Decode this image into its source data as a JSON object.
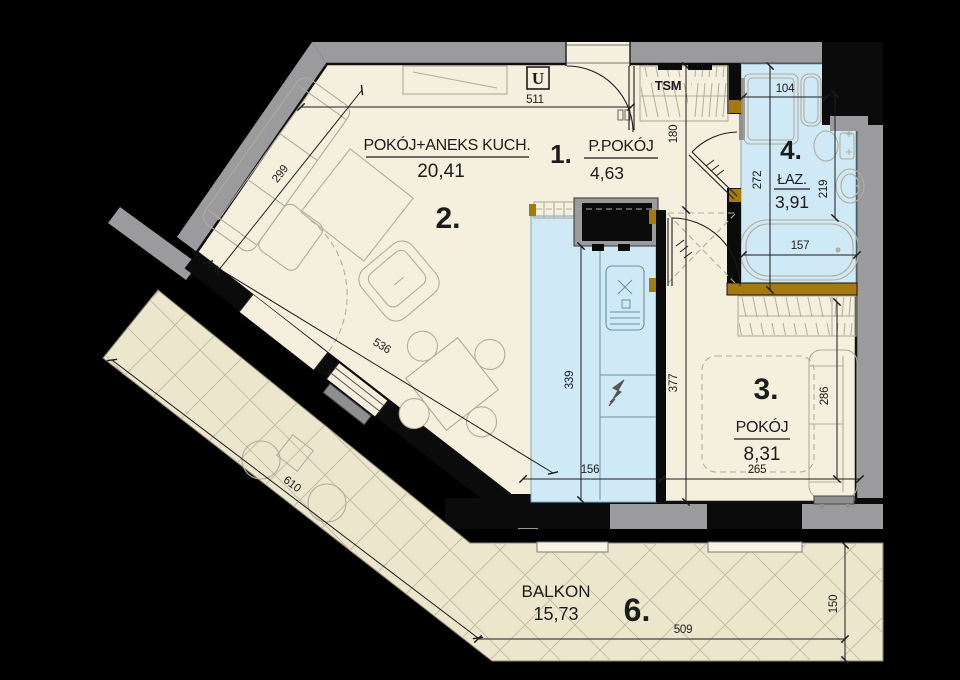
{
  "plan_title": "apartment-floor-plan",
  "rooms": {
    "r1": {
      "number": "1.",
      "name": "P.POKÓJ",
      "area": "4,63"
    },
    "r2": {
      "number": "2.",
      "name": "POKÓJ+ANEKS KUCH.",
      "area": "20,41"
    },
    "r3": {
      "number": "3.",
      "name": "POKÓJ",
      "area": "8,31"
    },
    "r4": {
      "number": "4.",
      "name": "ŁAZ.",
      "area": "3,91"
    },
    "r6": {
      "number": "6.",
      "name": "BALKON",
      "area": "15,73"
    }
  },
  "annotations": {
    "shaft_label": "TSM",
    "entrance_symbol": "U"
  },
  "dimensions_cm": {
    "d511": "511",
    "d299": "299",
    "d536": "536",
    "d339": "339",
    "d156": "156",
    "d377": "377",
    "d180": "180",
    "d272": "272",
    "d219": "219",
    "d104": "104",
    "d157": "157",
    "d286": "286",
    "d265": "265",
    "d610": "610",
    "d509": "509",
    "d150": "150"
  },
  "colors": {
    "background": "#000000",
    "floor": "#f5efdd",
    "wet_room_floor": "#cfe9f7",
    "balcony_floor": "#ece6cd",
    "wall_gray": "#9b9b9d",
    "wall_black": "#0b0b0b",
    "door_frame_brown": "#a6790e",
    "furniture_line": "#b2ac9b",
    "dimension_line": "#1c1c1c"
  }
}
